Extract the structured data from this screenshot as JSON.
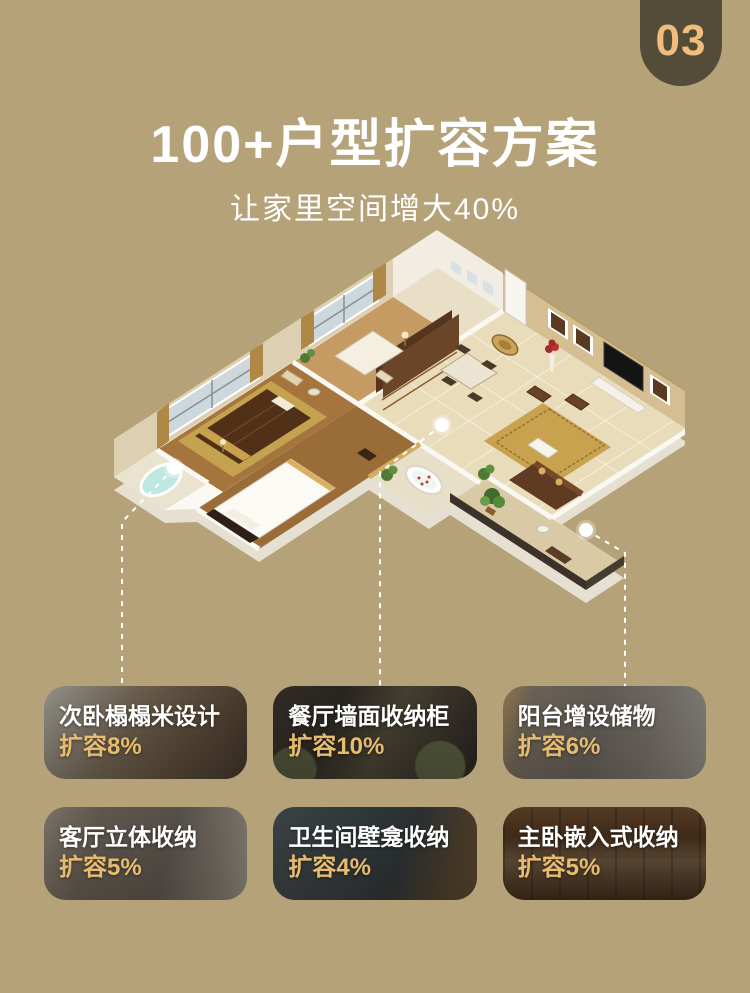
{
  "page": {
    "background": "#b6a278"
  },
  "badge": {
    "number": "03"
  },
  "header": {
    "title": "100+户型扩容方案",
    "subtitle": "让家里空间增大40%"
  },
  "colors": {
    "background": "#b6a278",
    "badge_bg": "#524c38",
    "badge_text": "#f0bd7e",
    "accent_gold": "#e8bc6f",
    "card_label": "#ffffff",
    "connector_line": "#ffffff"
  },
  "floorplan": {
    "description": "3D isometric apartment floor plan render with three white callout markers linked by dashed lines to the cards below"
  },
  "cards": [
    {
      "label": "次卧榻榻米设计",
      "value": "扩容8%"
    },
    {
      "label": "餐厅墙面收纳柜",
      "value": "扩容10%"
    },
    {
      "label": "阳台增设储物",
      "value": "扩容6%"
    },
    {
      "label": "客厅立体收纳",
      "value": "扩容5%"
    },
    {
      "label": "卫生间壁龛收纳",
      "value": "扩容4%"
    },
    {
      "label": "主卧嵌入式收纳",
      "value": "扩容5%"
    }
  ]
}
